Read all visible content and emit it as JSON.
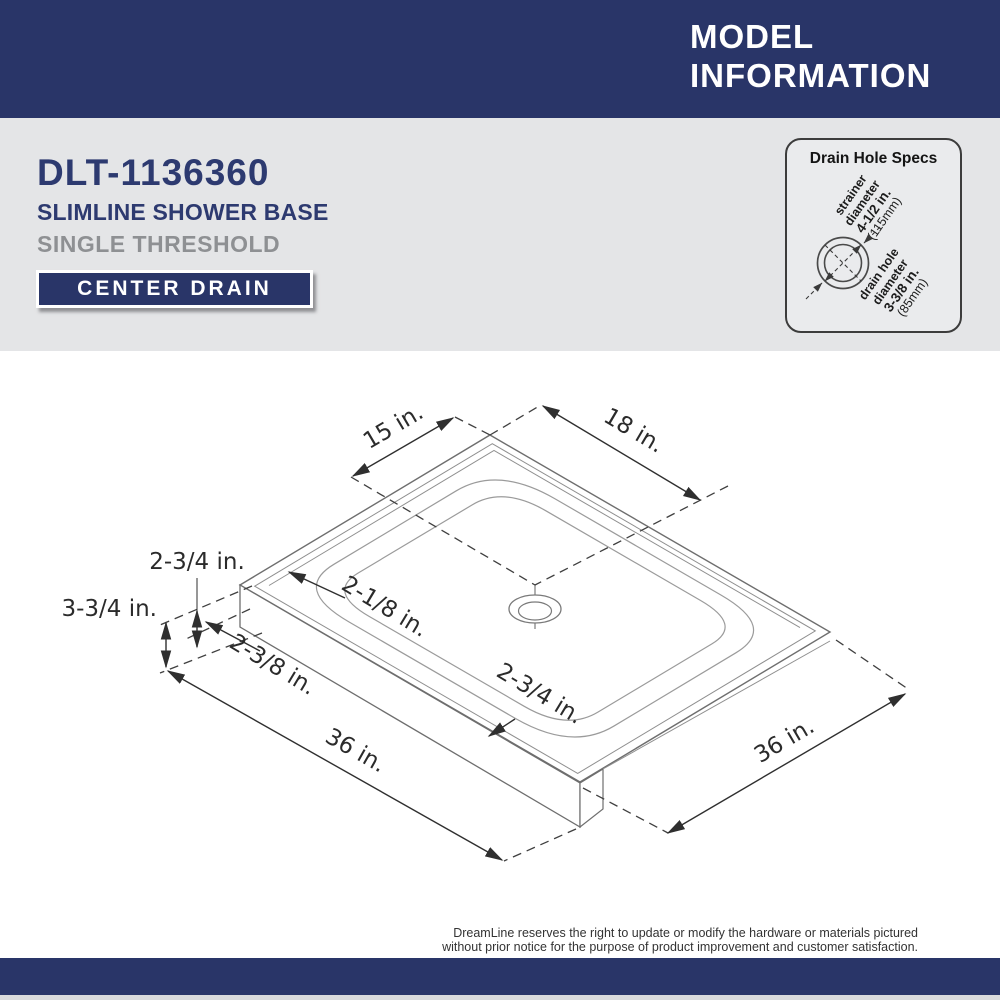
{
  "header": {
    "title_line1": "MODEL",
    "title_line2": "INFORMATION"
  },
  "product": {
    "model_number": "DLT-1136360",
    "product_line": "SLIMLINE SHOWER BASE",
    "threshold_type": "SINGLE THRESHOLD",
    "drain_badge": "CENTER DRAIN"
  },
  "drain_specs": {
    "title": "Drain Hole Specs",
    "strainer": {
      "label_line1": "strainer",
      "label_line2": "diameter",
      "value_in": "4-1/2 in.",
      "value_mm": "(115mm)"
    },
    "drain_hole": {
      "label_line1": "drain hole",
      "label_line2": "diameter",
      "value_in": "3-3/8 in.",
      "value_mm": "(85mm)"
    }
  },
  "diagram": {
    "dimensions": {
      "drain_offset_left": "15 in.",
      "drain_offset_right": "18 in.",
      "ledge_height": "2-3/4 in.",
      "overall_height": "3-3/4 in.",
      "dam_width": "2-1/8 in.",
      "threshold_depth": "2-3/8 in.",
      "front_dam_width": "2-3/4 in.",
      "base_width_left": "36 in.",
      "base_width_right": "36 in."
    }
  },
  "footer": {
    "disclaimer_line1": "DreamLine reserves the right to update or modify the hardware or materials pictured",
    "disclaimer_line2": "without prior notice for the purpose of product improvement and customer satisfaction."
  },
  "colors": {
    "navy": "#293568",
    "navy_text": "#2d3a70",
    "band_gray": "#e4e5e7",
    "card_gray": "#eaebed",
    "muted_gray": "#8e9093",
    "ink": "#2b2b2b"
  }
}
